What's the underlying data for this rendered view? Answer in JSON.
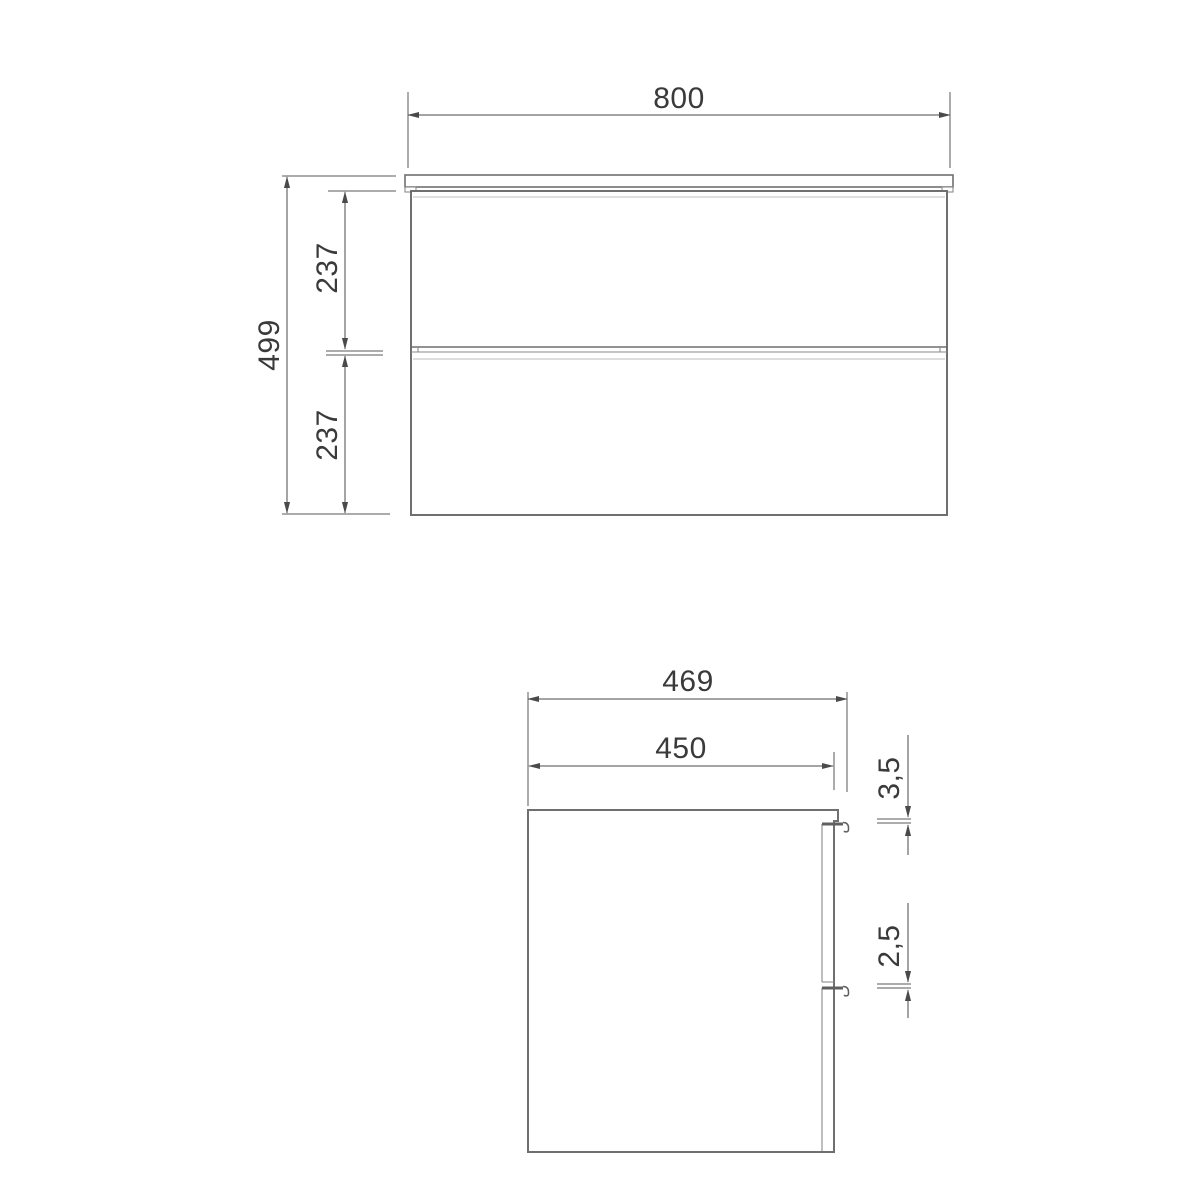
{
  "front_view": {
    "width": "800",
    "height": "499",
    "top_drawer": "237",
    "bottom_drawer": "237"
  },
  "side_view": {
    "overall_depth": "469",
    "carcass_depth": "450",
    "top_gap": "3,5",
    "drawer_gap": "2,5"
  },
  "colors": {
    "background": "#ffffff",
    "object_line": "#6f6f6f",
    "light_line": "#bcbcbc",
    "dimension_line": "#4a4a4a",
    "text": "#3a3a3a"
  }
}
